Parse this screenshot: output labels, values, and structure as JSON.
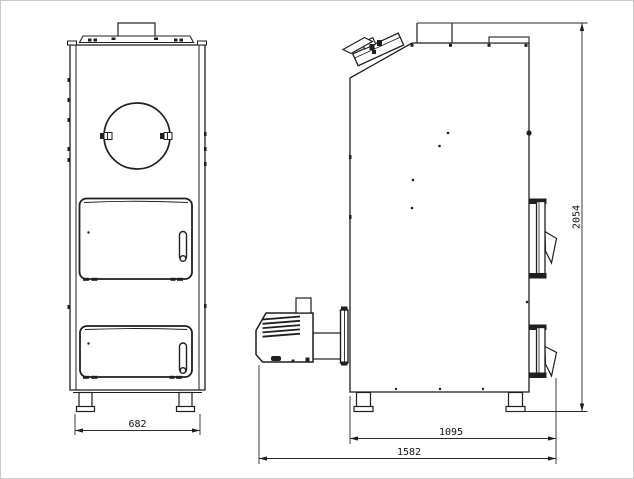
{
  "diagram": {
    "dimensions": {
      "front_width": "682",
      "body_depth": "1095",
      "overall_depth": "1582",
      "overall_height": "2054"
    },
    "colors": {
      "line": "#1f1f1f",
      "background": "#ffffff",
      "frame": "#c9c9c9"
    }
  }
}
